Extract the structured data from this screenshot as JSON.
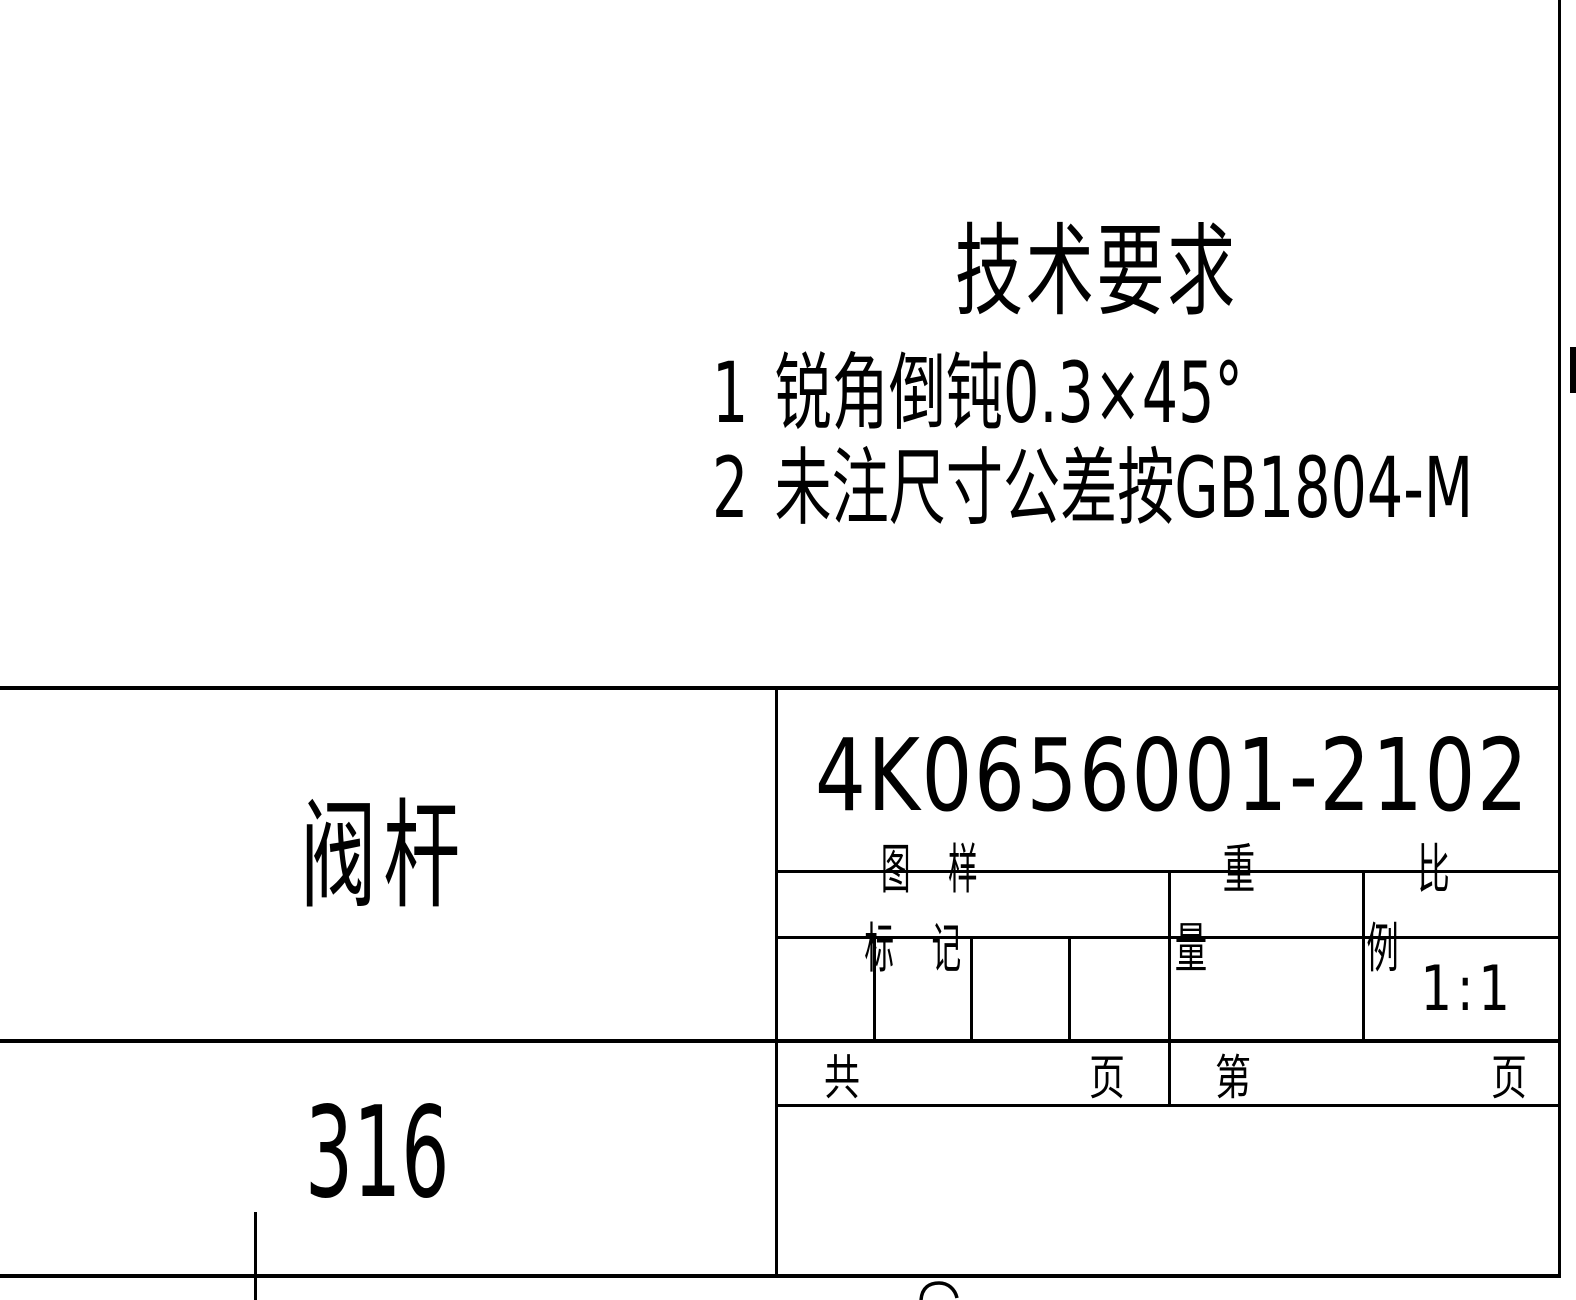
{
  "tech_requirements": {
    "title": "技术要求",
    "items": [
      {
        "num": "1",
        "text": "锐角倒钝0.3×45°"
      },
      {
        "num": "2",
        "text": "未注尺寸公差按GB1804-M"
      }
    ]
  },
  "title_block": {
    "part_name": "阀杆",
    "drawing_number": "4K0656001-2102",
    "material": "316",
    "mark_header": "图样标记",
    "weight_header": "重量",
    "scale_header": "比例",
    "scale_value": "1:1",
    "total_pages_prefix": "共",
    "total_pages_suffix": "页",
    "page_number_prefix": "第",
    "page_number_suffix": "页"
  },
  "colors": {
    "line": "#000000",
    "background": "#ffffff"
  }
}
